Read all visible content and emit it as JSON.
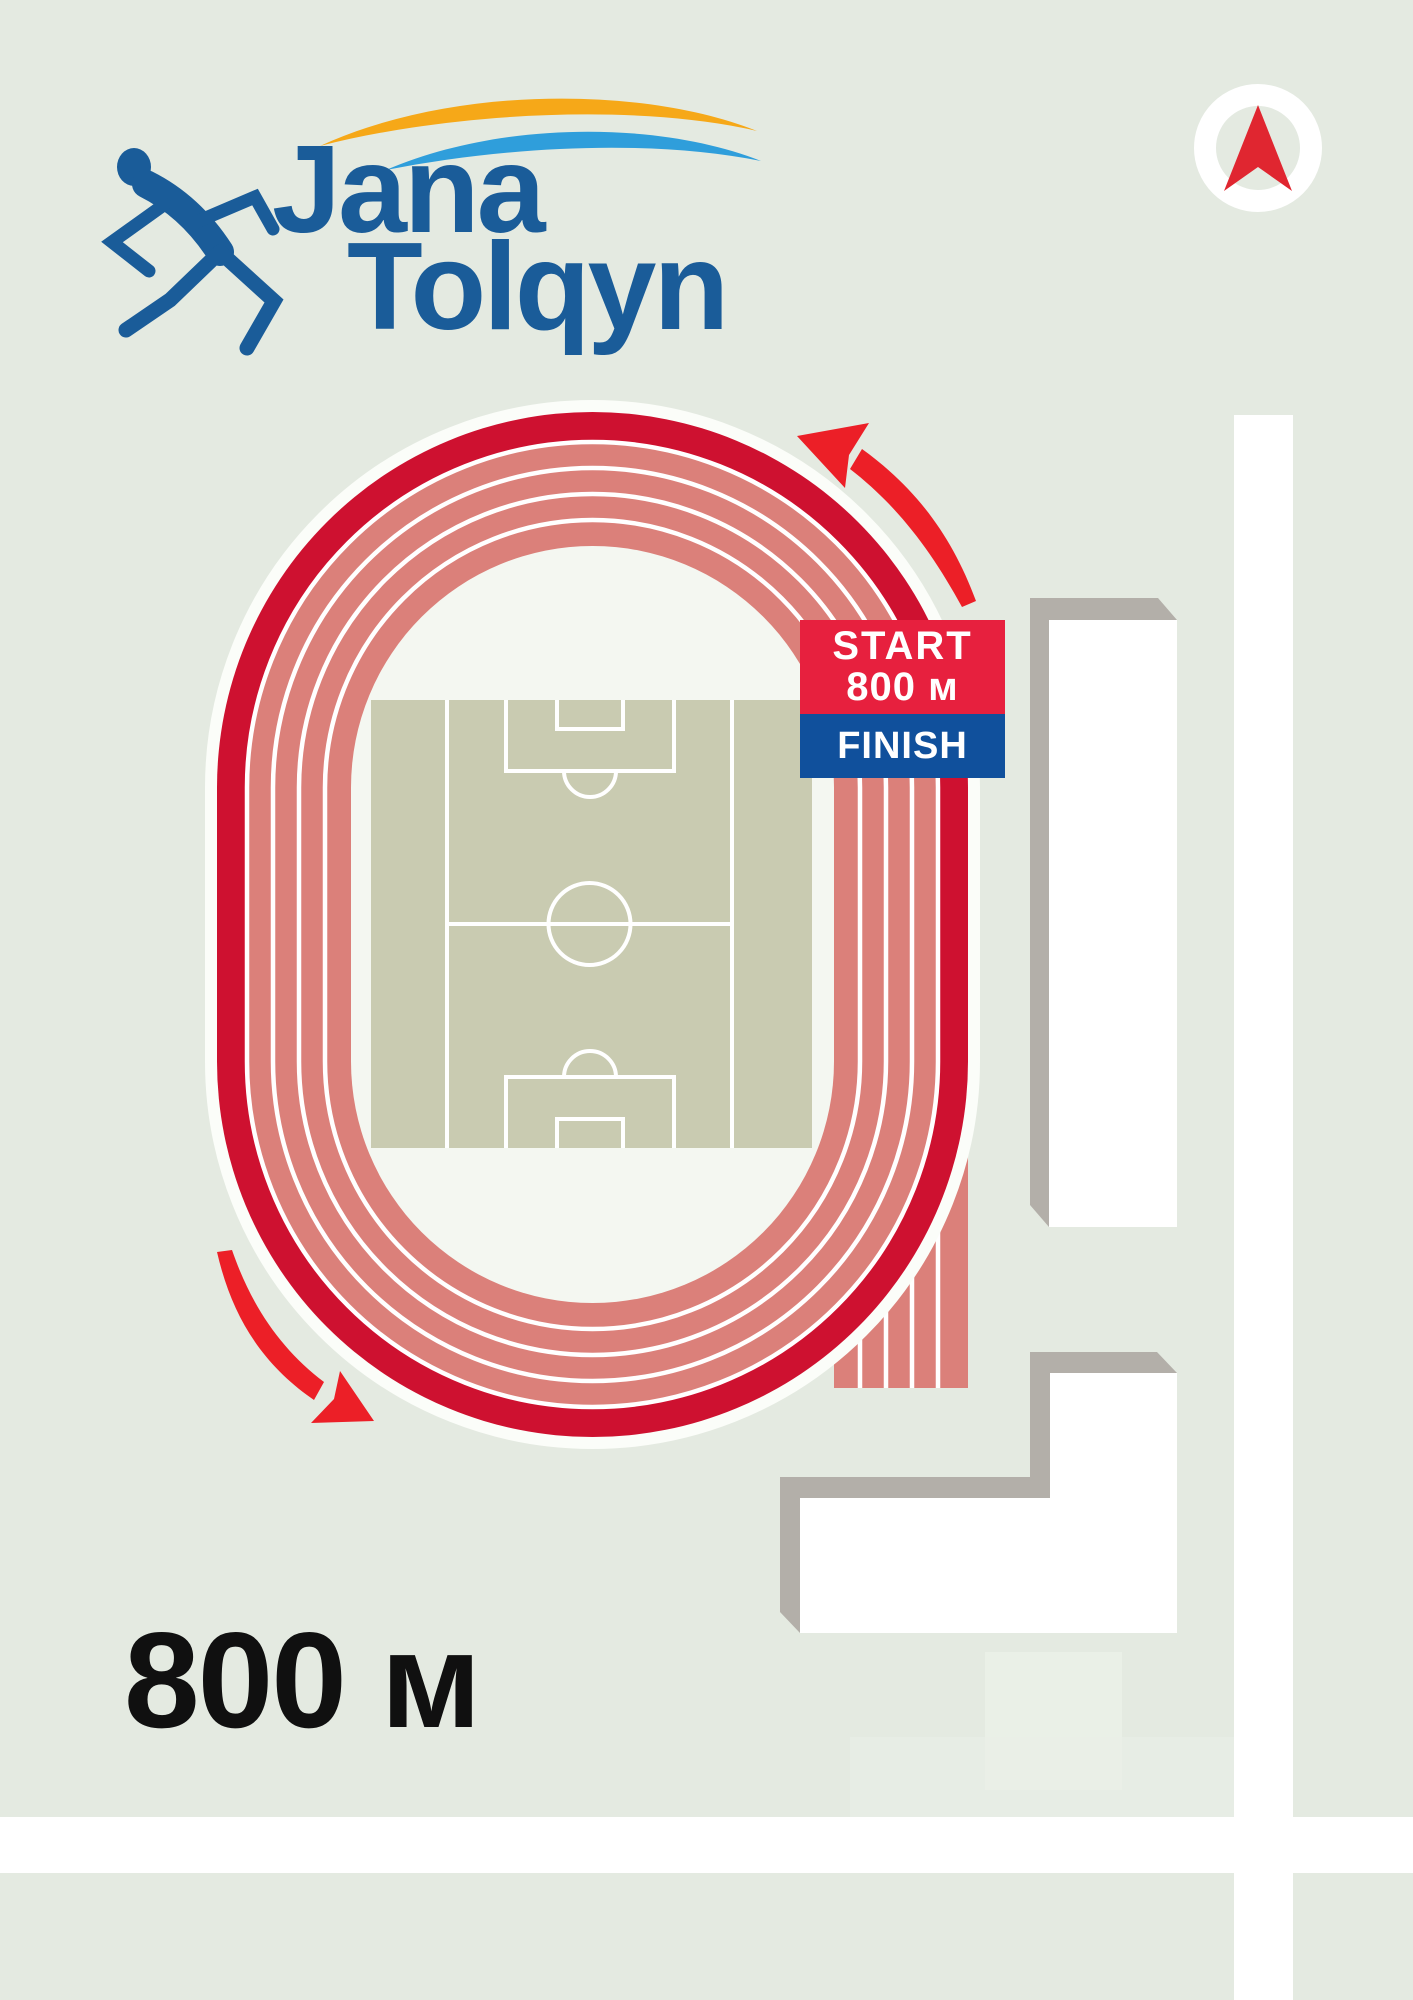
{
  "logo": {
    "line1": "Jana",
    "line2": "Tolqyn"
  },
  "badge": {
    "start": "START",
    "distance": "800 м",
    "finish": "FINISH"
  },
  "distance_label": "800 м",
  "track": {
    "lane_count": 5,
    "direction": "counterclockwise"
  },
  "icons": {
    "compass": "north-arrow-icon",
    "runner": "runner-silhouette-icon",
    "swoosh": "logo-wave-swoosh",
    "direction_arrows": "curved-counterclockwise-arrow"
  },
  "colors": {
    "background": "#e4eae1",
    "track_outer_red": "#ce1130",
    "track_lane_pink": "#db807a",
    "infield_white": "#f4f7f1",
    "field_tan": "#c9cbb1",
    "field_line": "#ffffff",
    "badge_red": "#e7203e",
    "badge_blue": "#10509c",
    "arrow_red": "#ec1f27",
    "logo_blue": "#1a5c99",
    "swoosh_orange": "#f6a818",
    "swoosh_blue": "#2f9edb",
    "building_gray": "#b3afa9",
    "road_white": "#ffffff",
    "label_black": "#101010"
  }
}
